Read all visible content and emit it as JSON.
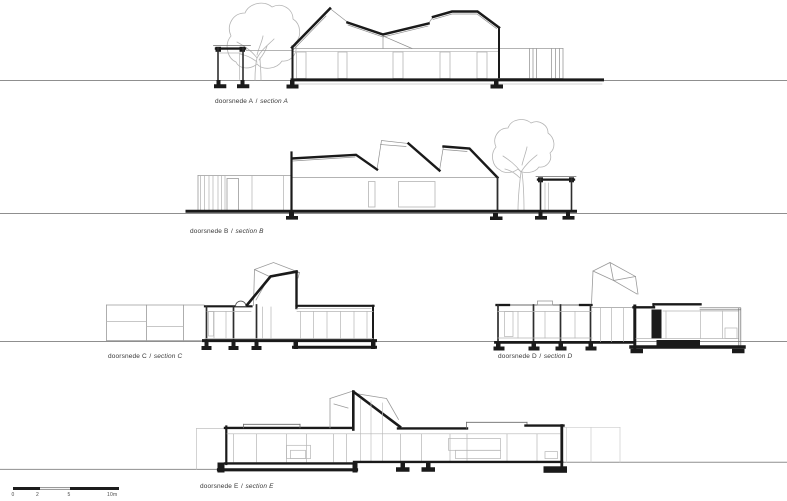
{
  "sections": [
    {
      "id": "A",
      "label_nl": "doorsnede A",
      "separator": "/",
      "label_en": "section A"
    },
    {
      "id": "B",
      "label_nl": "doorsnede B",
      "separator": "/",
      "label_en": "section B"
    },
    {
      "id": "C",
      "label_nl": "doorsnede C",
      "separator": "/",
      "label_en": "section C"
    },
    {
      "id": "D",
      "label_nl": "doorsnede D",
      "separator": "/",
      "label_en": "section D"
    },
    {
      "id": "E",
      "label_nl": "doorsnede E",
      "separator": "/",
      "label_en": "section E"
    }
  ],
  "scale_bar": {
    "ticks": [
      "0",
      "2",
      "5",
      "10m"
    ]
  },
  "colors": {
    "line_heavy": "#1a1a1a",
    "line_wall": "#2e2e2e",
    "line_ground": "#8f8f8f",
    "line_light": "#b5b5b5",
    "label_text": "#383838"
  }
}
